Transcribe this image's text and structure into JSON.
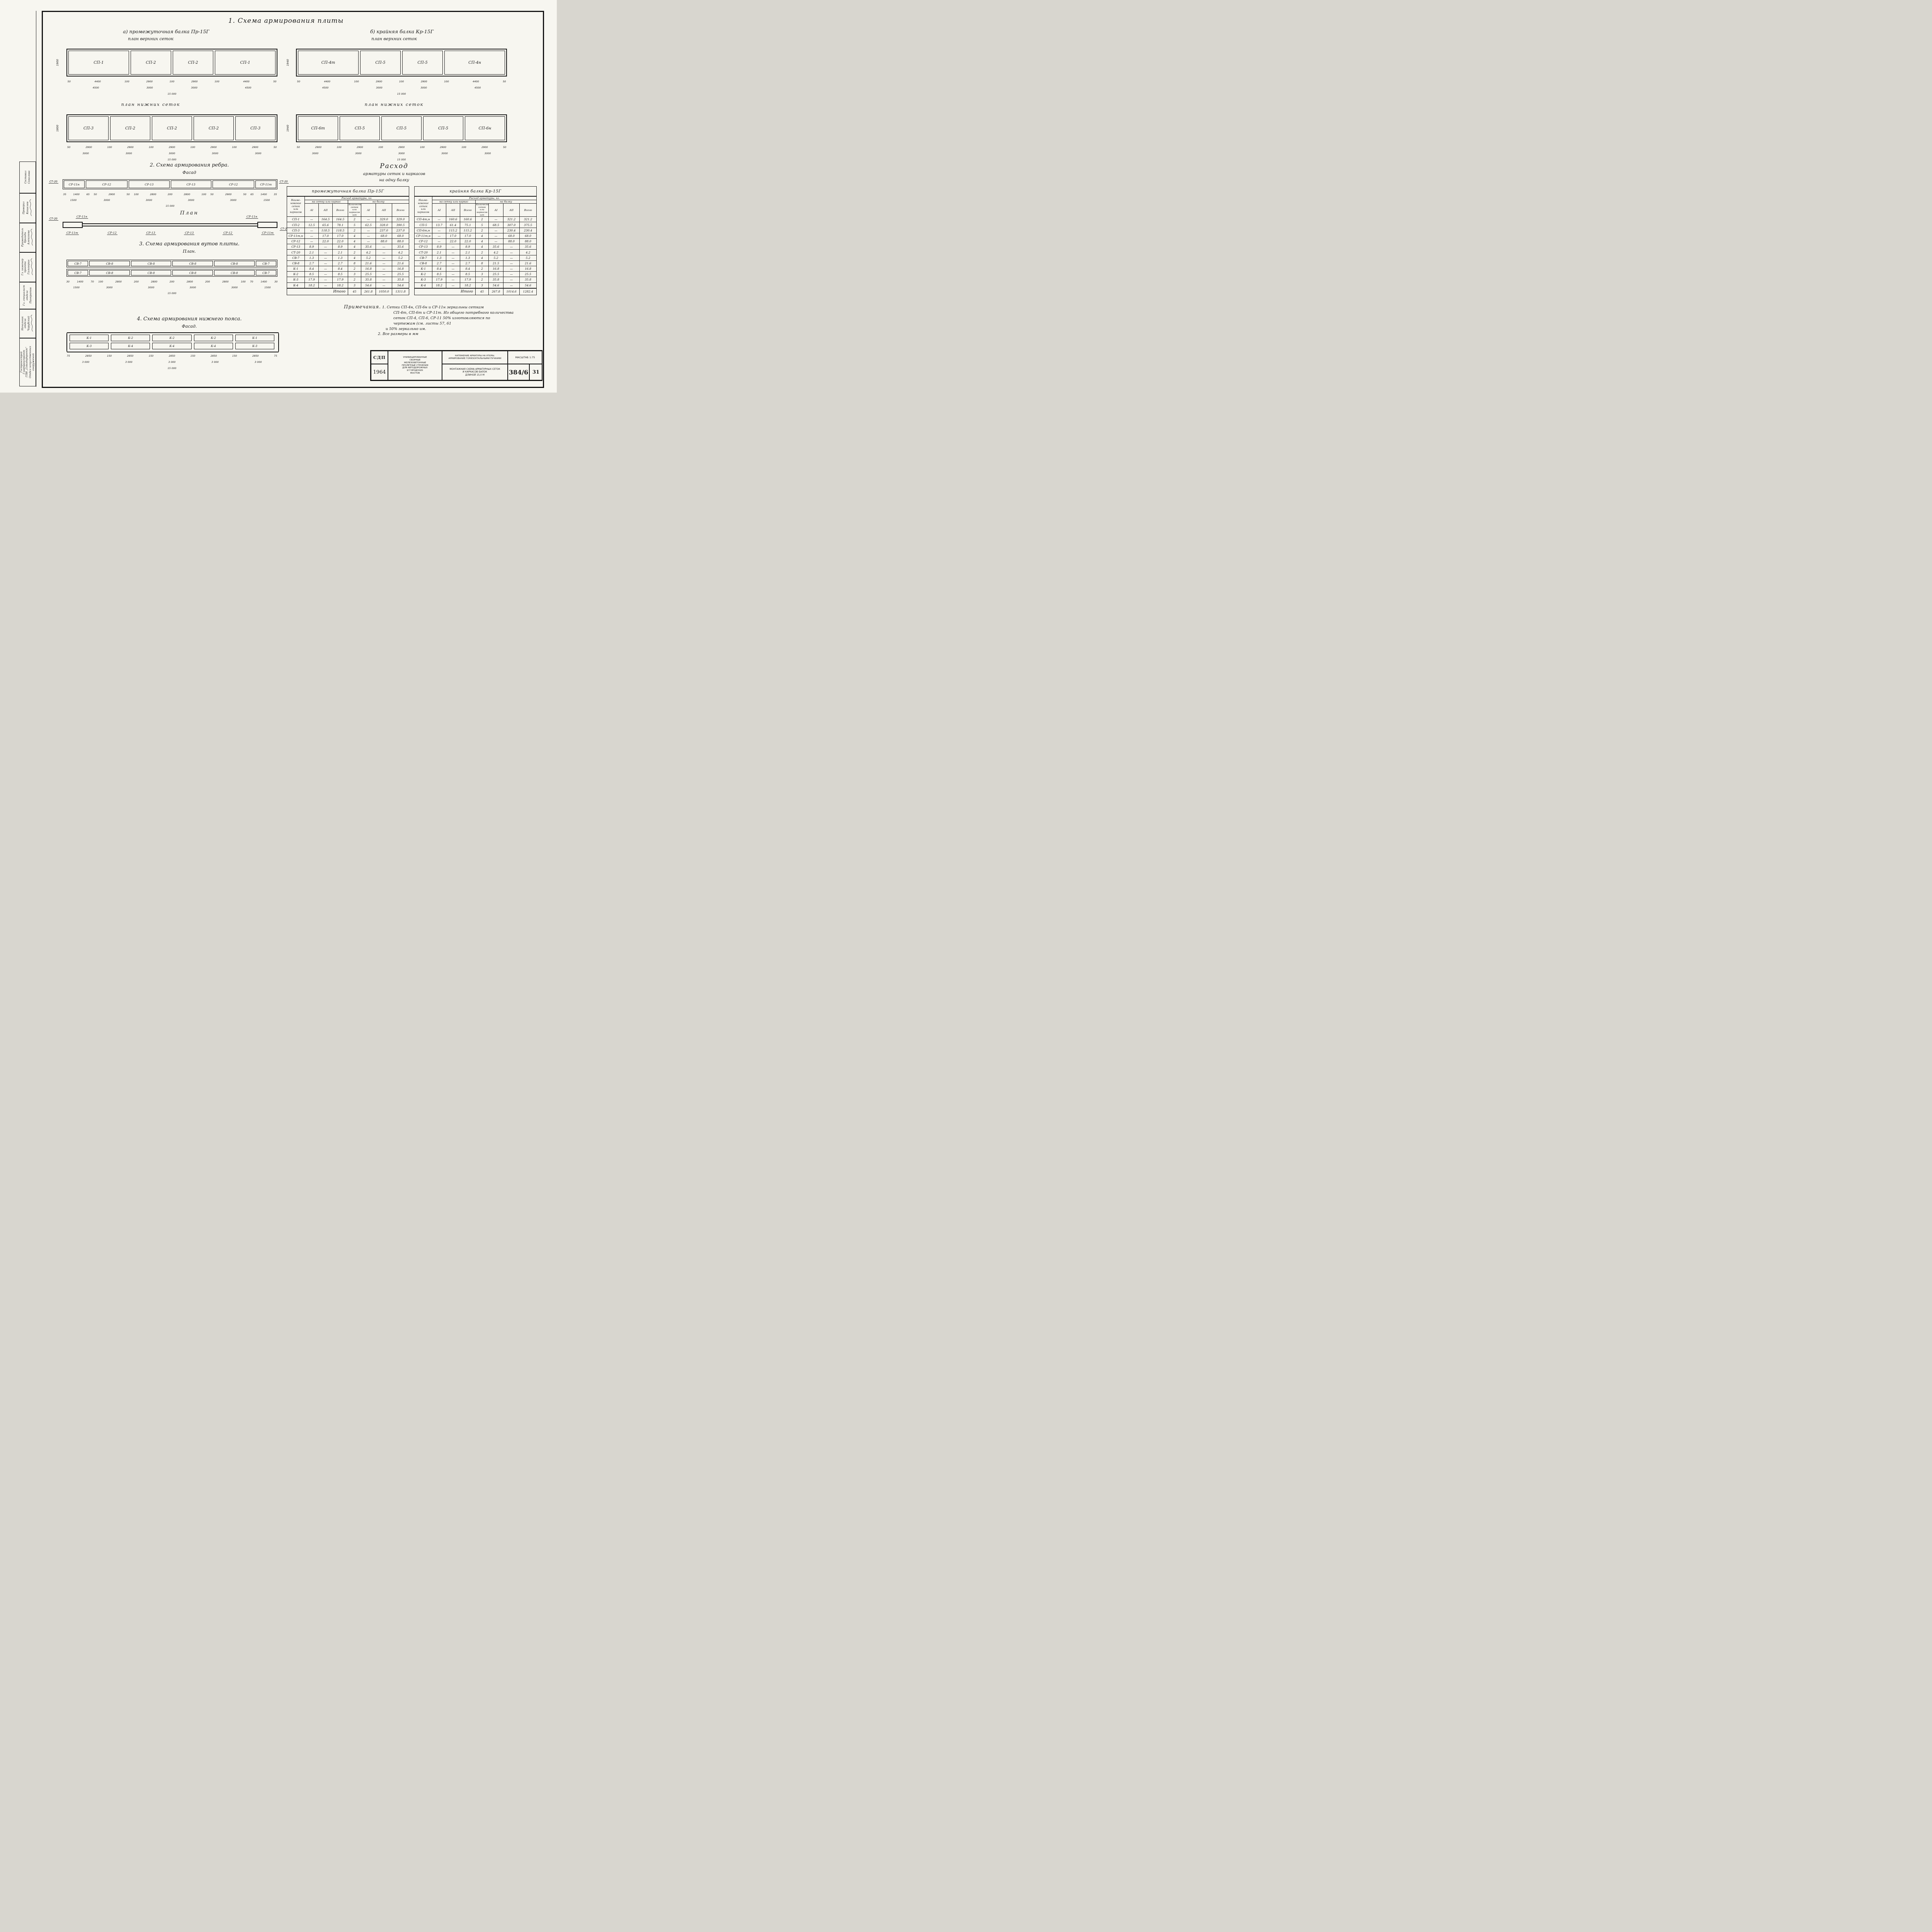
{
  "title": "1. Схема армирования плиты",
  "group_a": {
    "subtitle_1": "а) промежуточная балка Пр-15Г",
    "subtitle_2": "план верхних сеток",
    "upper": {
      "cells": [
        "СП-1",
        "СП-2",
        "СП-2",
        "СП-1"
      ],
      "cell_widths": [
        "4500",
        "3000",
        "3000",
        "4500"
      ],
      "height_label": "1900",
      "dims_1": [
        "50",
        "4400",
        "100",
        "2900",
        "100",
        "2900",
        "100",
        "4400",
        "50"
      ],
      "dims_2": [
        "4500",
        "3000",
        "3000",
        "4500"
      ],
      "dims_3": [
        "15 000"
      ]
    },
    "lower_label": "план нижних сеток",
    "lower": {
      "cells": [
        "СП-3",
        "СП-2",
        "СП-2",
        "СП-2",
        "СП-3"
      ],
      "cell_widths": [
        "3000",
        "3000",
        "3000",
        "3000",
        "3000"
      ],
      "height_label": "1800",
      "dims_1": [
        "50",
        "2900",
        "100",
        "2900",
        "100",
        "2900",
        "100",
        "2900",
        "100",
        "2900",
        "50"
      ],
      "dims_2": [
        "3000",
        "3000",
        "3000",
        "3000",
        "3000"
      ],
      "dims_3": [
        "15 000"
      ]
    }
  },
  "group_b": {
    "subtitle_1": "б) крайняя балка Кр-15Г",
    "subtitle_2": "план верхних сеток",
    "upper": {
      "cells": [
        "СП-4т",
        "СП-5",
        "СП-5",
        "СП-4н"
      ],
      "cell_widths": [
        "4500",
        "3000",
        "3000",
        "4500"
      ],
      "height_label": "1940",
      "dims_1": [
        "50",
        "4400",
        "100",
        "2900",
        "100",
        "2900",
        "100",
        "4400",
        "50"
      ],
      "dims_2": [
        "4500",
        "3000",
        "3000",
        "4500"
      ],
      "dims_3": [
        "15 000"
      ]
    },
    "lower_label": "план нижних сеток",
    "lower": {
      "cells": [
        "СП-6т",
        "СП-5",
        "СП-5",
        "СП-5",
        "СП-6н"
      ],
      "cell_widths": [
        "3000",
        "3000",
        "3000",
        "3000",
        "3000"
      ],
      "height_label": "1940",
      "dims_1": [
        "50",
        "2900",
        "100",
        "2900",
        "100",
        "2900",
        "100",
        "2900",
        "100",
        "2900",
        "50"
      ],
      "dims_2": [
        "3000",
        "3000",
        "3000",
        "3000",
        "3000"
      ],
      "dims_3": [
        "15 000"
      ]
    }
  },
  "section_2": {
    "title": "2. Схема армирования ребра.",
    "subtitle": "Фасад",
    "st20": "СТ-20",
    "boxes": [
      "СР-11н",
      "СР-12",
      "СР-13",
      "СР-13",
      "СР-12",
      "СР-11т"
    ],
    "box_widths": [
      "1400",
      "2900",
      "2800",
      "2800",
      "2900",
      "1400"
    ],
    "dims_1": [
      "35",
      "1400",
      "65",
      "50",
      "2900",
      "50",
      "100",
      "2800",
      "200",
      "2800",
      "100",
      "50",
      "2900",
      "50",
      "65",
      "1400",
      "35"
    ],
    "dims_2": [
      "1500",
      "3000",
      "3000",
      "3000",
      "3000",
      "1500"
    ],
    "dims_3": [
      "15 000"
    ],
    "plan_label": "План",
    "plan_top_left": "СР-11н",
    "plan_top_right": "СР-11н",
    "plan_bottom_labels": [
      "СР-11т",
      "СР-12",
      "СР-13",
      "СР-13",
      "СР-12",
      "СР-11т"
    ]
  },
  "section_3": {
    "title": "3. Схема армирования вутов плиты.",
    "subtitle": "План.",
    "row_1": [
      "СВ-7",
      "СВ-8",
      "СВ-8",
      "СВ-8",
      "СВ-8",
      "СВ-7"
    ],
    "row_2": [
      "СВ-7",
      "СВ-8",
      "СВ-8",
      "СВ-8",
      "СВ-8",
      "СВ-7"
    ],
    "box_widths": [
      "1400",
      "2800",
      "2800",
      "2800",
      "2800",
      "1400"
    ],
    "dims_1": [
      "30",
      "1400",
      "70",
      "100",
      "2800",
      "200",
      "2800",
      "200",
      "2800",
      "200",
      "2800",
      "100",
      "70",
      "1400",
      "30"
    ],
    "dims_2": [
      "1500",
      "3000",
      "3000",
      "3000",
      "3000",
      "1500"
    ],
    "dims_3": [
      "15 000"
    ]
  },
  "section_4": {
    "title": "4. Схема армирования нижнего пояса.",
    "subtitle": "Фасад.",
    "row_1": [
      "К-1",
      "К-2",
      "К-2",
      "К-2",
      "К-1"
    ],
    "row_2": [
      "К-3",
      "К-4",
      "К-4",
      "К-4",
      "К-3"
    ],
    "row_widths": [
      "3000",
      "3000",
      "3000",
      "3000",
      "3000"
    ],
    "dims_1": [
      "75",
      "2850",
      "150",
      "2850",
      "150",
      "2850",
      "150",
      "2850",
      "150",
      "2850",
      "75"
    ],
    "dims_2": [
      "3 000",
      "3 000",
      "3 000",
      "3 000",
      "3 000"
    ],
    "dims_3": [
      "15 000"
    ]
  },
  "consumption": {
    "heading_1": "Расход",
    "heading_2": "арматуры сеток и каркасов",
    "heading_3": "на одну балку",
    "header": {
      "name": "Наиме-\nнование\nсеток\nили\nкаркасов",
      "expense": "Расход арматуры, кг.",
      "per_item": "на сетку или каркас",
      "per_beam": "на балку",
      "qty": "Количество\nсеток или\nкаркасов\nшт",
      "a1": "АI",
      "a2": "АII",
      "total": "Всего"
    },
    "table_left": {
      "title": "промежуточная балка Пр-15Г",
      "rows": [
        [
          "СП-1",
          "—",
          "164.5",
          "164.5",
          "2",
          "—",
          "329.0",
          "329.0"
        ],
        [
          "СП-2",
          "12.5",
          "65.6",
          "78.1",
          "5",
          "62.5",
          "328.0",
          "390.5"
        ],
        [
          "СП-3",
          "—",
          "118.5",
          "118.5",
          "2",
          "—",
          "237.0",
          "237.0"
        ],
        [
          "СР-11т,н",
          "—",
          "17.0",
          "17.0",
          "4",
          "—",
          "68.0",
          "68.0"
        ],
        [
          "СР-12",
          "—",
          "22.0",
          "22.0",
          "4",
          "—",
          "88.0",
          "88.0"
        ],
        [
          "СР-13",
          "8.9",
          "—",
          "8.9",
          "4",
          "35.6",
          "—",
          "35.6"
        ],
        [
          "СТ-20",
          "2.1",
          "—",
          "2.1",
          "2",
          "4.2",
          "—",
          "4.2"
        ],
        [
          "СВ-7",
          "1.3",
          "—",
          "1.3",
          "4",
          "5.2",
          "—",
          "5.2"
        ],
        [
          "СВ-8",
          "2.7",
          "—",
          "2.7",
          "8",
          "21.6",
          "—",
          "21.6"
        ],
        [
          "К-1",
          "8.4",
          "—",
          "8.4",
          "2",
          "16.8",
          "—",
          "16.8"
        ],
        [
          "К-2",
          "8.5",
          "—",
          "8.5",
          "3",
          "25.5",
          "—",
          "25.5"
        ],
        [
          "К-3",
          "17.9",
          "—",
          "17.9",
          "2",
          "35.8",
          "—",
          "35.8"
        ],
        [
          "К-4",
          "18.2",
          "—",
          "18.2",
          "3",
          "54.6",
          "—",
          "54.6"
        ]
      ],
      "total_label": "Итого",
      "totals": [
        "45",
        "261.8",
        "1050.0",
        "1311.8"
      ]
    },
    "table_right": {
      "title": "крайняя балка Кр-15Г",
      "rows": [
        [
          "СП-4т,н",
          "—",
          "160.6",
          "160.6",
          "2",
          "—",
          "321.2",
          "321.2"
        ],
        [
          "СП-5",
          "13.7",
          "61.4",
          "75.1",
          "5",
          "68.5",
          "307.0",
          "375.5"
        ],
        [
          "СП-6т,н",
          "—",
          "115.2",
          "115.2",
          "2",
          "—",
          "230.4",
          "230.4"
        ],
        [
          "СР-11т,н",
          "—",
          "17.0",
          "17.0",
          "4",
          "—",
          "68.0",
          "68.0"
        ],
        [
          "СР-12",
          "—",
          "22.0",
          "22.0",
          "4",
          "—",
          "88.0",
          "88.0"
        ],
        [
          "СР-13",
          "8.9",
          "—",
          "8.9",
          "4",
          "35.6",
          "—",
          "35.6"
        ],
        [
          "СТ-20",
          "2.1",
          "—",
          "2.1",
          "2",
          "4.2",
          "—",
          "4.2"
        ],
        [
          "СВ-7",
          "1.3",
          "—",
          "1.3",
          "4",
          "5.2",
          "—",
          "5.2"
        ],
        [
          "СВ-8",
          "2.7",
          "—",
          "2.7",
          "8",
          "21.5",
          "—",
          "21.6"
        ],
        [
          "К-1",
          "8.4",
          "—",
          "8.4",
          "2",
          "16.8",
          "—",
          "16.8"
        ],
        [
          "К-2",
          "8.5",
          "—",
          "8.5",
          "3",
          "25.5",
          "—",
          "25.5"
        ],
        [
          "К-3",
          "17.9",
          "—",
          "17.9",
          "2",
          "35.8",
          "—",
          "35.8"
        ],
        [
          "К-4",
          "18.2",
          "—",
          "18.2",
          "3",
          "54.6",
          "—",
          "54.6"
        ]
      ],
      "total_label": "Итого",
      "totals": [
        "45",
        "267.8",
        "1014.6",
        "1282.4"
      ]
    }
  },
  "notes": {
    "label": "Примечания.",
    "lines": [
      "1. Сетки СП-4н, СП-6н и СР-11н зеркальны сеткам",
      "СП-4т, СП-6т и СР-11т. Из общего потребного количества",
      "сеток СП-4, СП-6, СР-11 50% изготовляются по",
      "чертежам (см. листы 57, 61",
      "и 50% зеркально им.",
      "2. Все размеры в мм"
    ]
  },
  "title_block": {
    "org_code": "СДП",
    "year": "1964",
    "series": "УНИФИЦИРОВАННЫЕ\nСБОРНЫЕ\nЖЕЛЕЗОБЕТОННЫЕ\nПРОЛЕТНЫЕ СТРОЕНИЯ\nДЛЯ АВТОДОРОЖНЫХ\nИ ГОРОДСКИХ\nМОСТОВ",
    "subject": "НАТЯЖЕНИЕ АРМАТУРЫ НА УПОРЫ.\nАРМИРОВАНИЕ ГОРИЗОНТАЛЬНЫМИ ПУЧКАМИ",
    "sheet_title": "МОНТАЖНАЯ СХЕМА АРМАТУРНЫХ СЕТОК\nИ КАРКАСОВ БАЛОК\nДЛИНОЙ 15,0 М",
    "scale": "МАСШТАБ 1:75",
    "doc_number": "384/6",
    "sheet_number": "31"
  },
  "sidebar": {
    "cells": [
      {
        "role": "Составил",
        "name": "Соколова"
      },
      {
        "role": "Проверил",
        "name": "Кошелев"
      },
      {
        "role": "Руководитель\nбригады",
        "name": "Алексеева"
      },
      {
        "role": "Гл. инженер\nпроекта",
        "name": "Гальперин"
      },
      {
        "role": "Гл. специалист\nотдела",
        "name": "Панкратов"
      },
      {
        "role": "Начальник\nотдела",
        "name": "Чарубский"
      },
      {
        "role": "Гострансстрой\nГлавтранспроект\nГПИ „Союздорпроект“",
        "name": "Отдел искусственных сооружений"
      }
    ]
  }
}
